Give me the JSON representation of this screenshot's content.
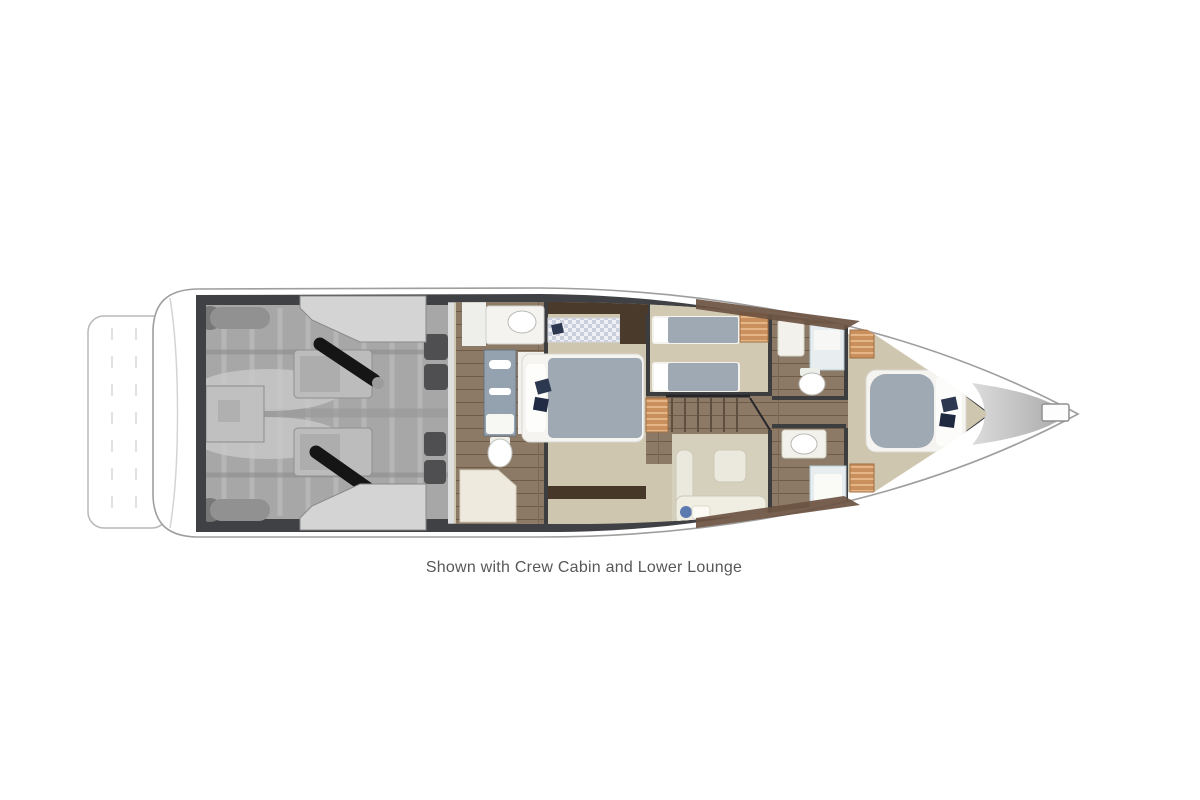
{
  "caption": {
    "text": "Shown with Crew Cabin and Lower Lounge"
  },
  "diagram": {
    "type": "yacht-lower-deck-floorplan",
    "orientation": "bow-right, stern-left, top-down view",
    "areas": [
      "swim platform",
      "engine room with twin engines and crew cabin hatches",
      "master stateroom with ensuite bathroom and shower",
      "twin guest cabin",
      "staircase to main deck",
      "lower lounge with L-shaped sofa and ottoman",
      "day head",
      "guest bathroom",
      "VIP stateroom forward",
      "foredeck anchor hatch"
    ],
    "palette": {
      "hull_outline": "#9e9e9e",
      "wall_charcoal": "#404144",
      "engine_gray": "#a7a7a7",
      "hatch_gray": "#d4d4d4",
      "exhaust_black": "#151515",
      "carpet_beige": "#cfc6af",
      "carpet_olive": "#d5d0bc",
      "carpet_twin": "#d2c9b2",
      "wood_brown": "#8c7a67",
      "walnut_dark": "#4a3a2b",
      "bed_blue": "#9fa9b4",
      "linen_white": "#f5f4f1",
      "locker_orange": "#c98f5d",
      "pillow_navy": "#2c3750",
      "caption_gray": "#57585a"
    }
  }
}
